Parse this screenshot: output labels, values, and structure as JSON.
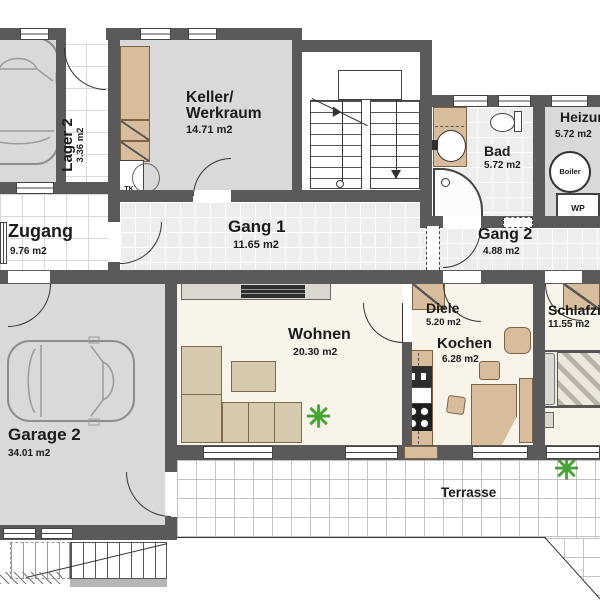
{
  "rooms": {
    "lager2": {
      "name": "Lager 2",
      "area": "3.36 m2"
    },
    "keller": {
      "name1": "Keller/",
      "name2": "Werkraum",
      "area": "14.71 m2"
    },
    "zugang": {
      "name": "Zugang",
      "area": "9.76 m2"
    },
    "gang1": {
      "name": "Gang 1",
      "area": "11.65 m2"
    },
    "bad": {
      "name": "Bad",
      "area": "5.72 m2"
    },
    "heizung": {
      "name": "Heizung",
      "area": "5.72 m2"
    },
    "gang2": {
      "name": "Gang 2",
      "area": "4.88 m2"
    },
    "wohnen": {
      "name": "Wohnen",
      "area": "20.30 m2"
    },
    "diele": {
      "name": "Diele",
      "area": "5.20 m2"
    },
    "kochen": {
      "name": "Kochen",
      "area": "6.28 m2"
    },
    "schlafzimmer": {
      "name": "Schlafzimmer",
      "area": "11.55 m2"
    },
    "garage2": {
      "name": "Garage 2",
      "area": "34.01 m2"
    },
    "terrasse": {
      "name": "Terrasse"
    }
  },
  "equipment": {
    "tk": "TK",
    "boiler": "Boiler",
    "wp": "WP"
  },
  "icons": {
    "plant": "✳"
  },
  "colors": {
    "wall": "#5a5a5a",
    "floor_gray": "#d9d9d9",
    "floor_cream": "#f8f4ea",
    "furniture_tan": "#d8bd9d",
    "plant_green": "#46a433"
  }
}
